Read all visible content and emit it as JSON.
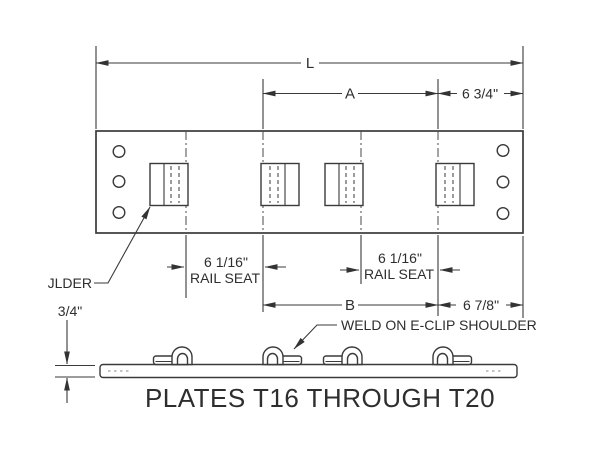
{
  "title": "PLATES T16 THROUGH T20",
  "colors": {
    "line": "#3a3a3a",
    "text": "#2e2e2e",
    "background": "#ffffff"
  },
  "top_view": {
    "overall_length_label": "L",
    "dim_a_label": "A",
    "offset_right_label": "6 3/4\"",
    "rail_seat_left": {
      "value": "6 1/16\"",
      "caption": "RAIL SEAT"
    },
    "rail_seat_right": {
      "value": "6 1/16\"",
      "caption": "RAIL SEAT"
    },
    "shoulder_leader_label": "JLDER"
  },
  "side_view": {
    "dim_b_label": "B",
    "offset_right_label": "6 7/8\"",
    "thickness_label": "3/4\"",
    "weld_note": "WELD ON E-CLIP SHOULDER"
  }
}
